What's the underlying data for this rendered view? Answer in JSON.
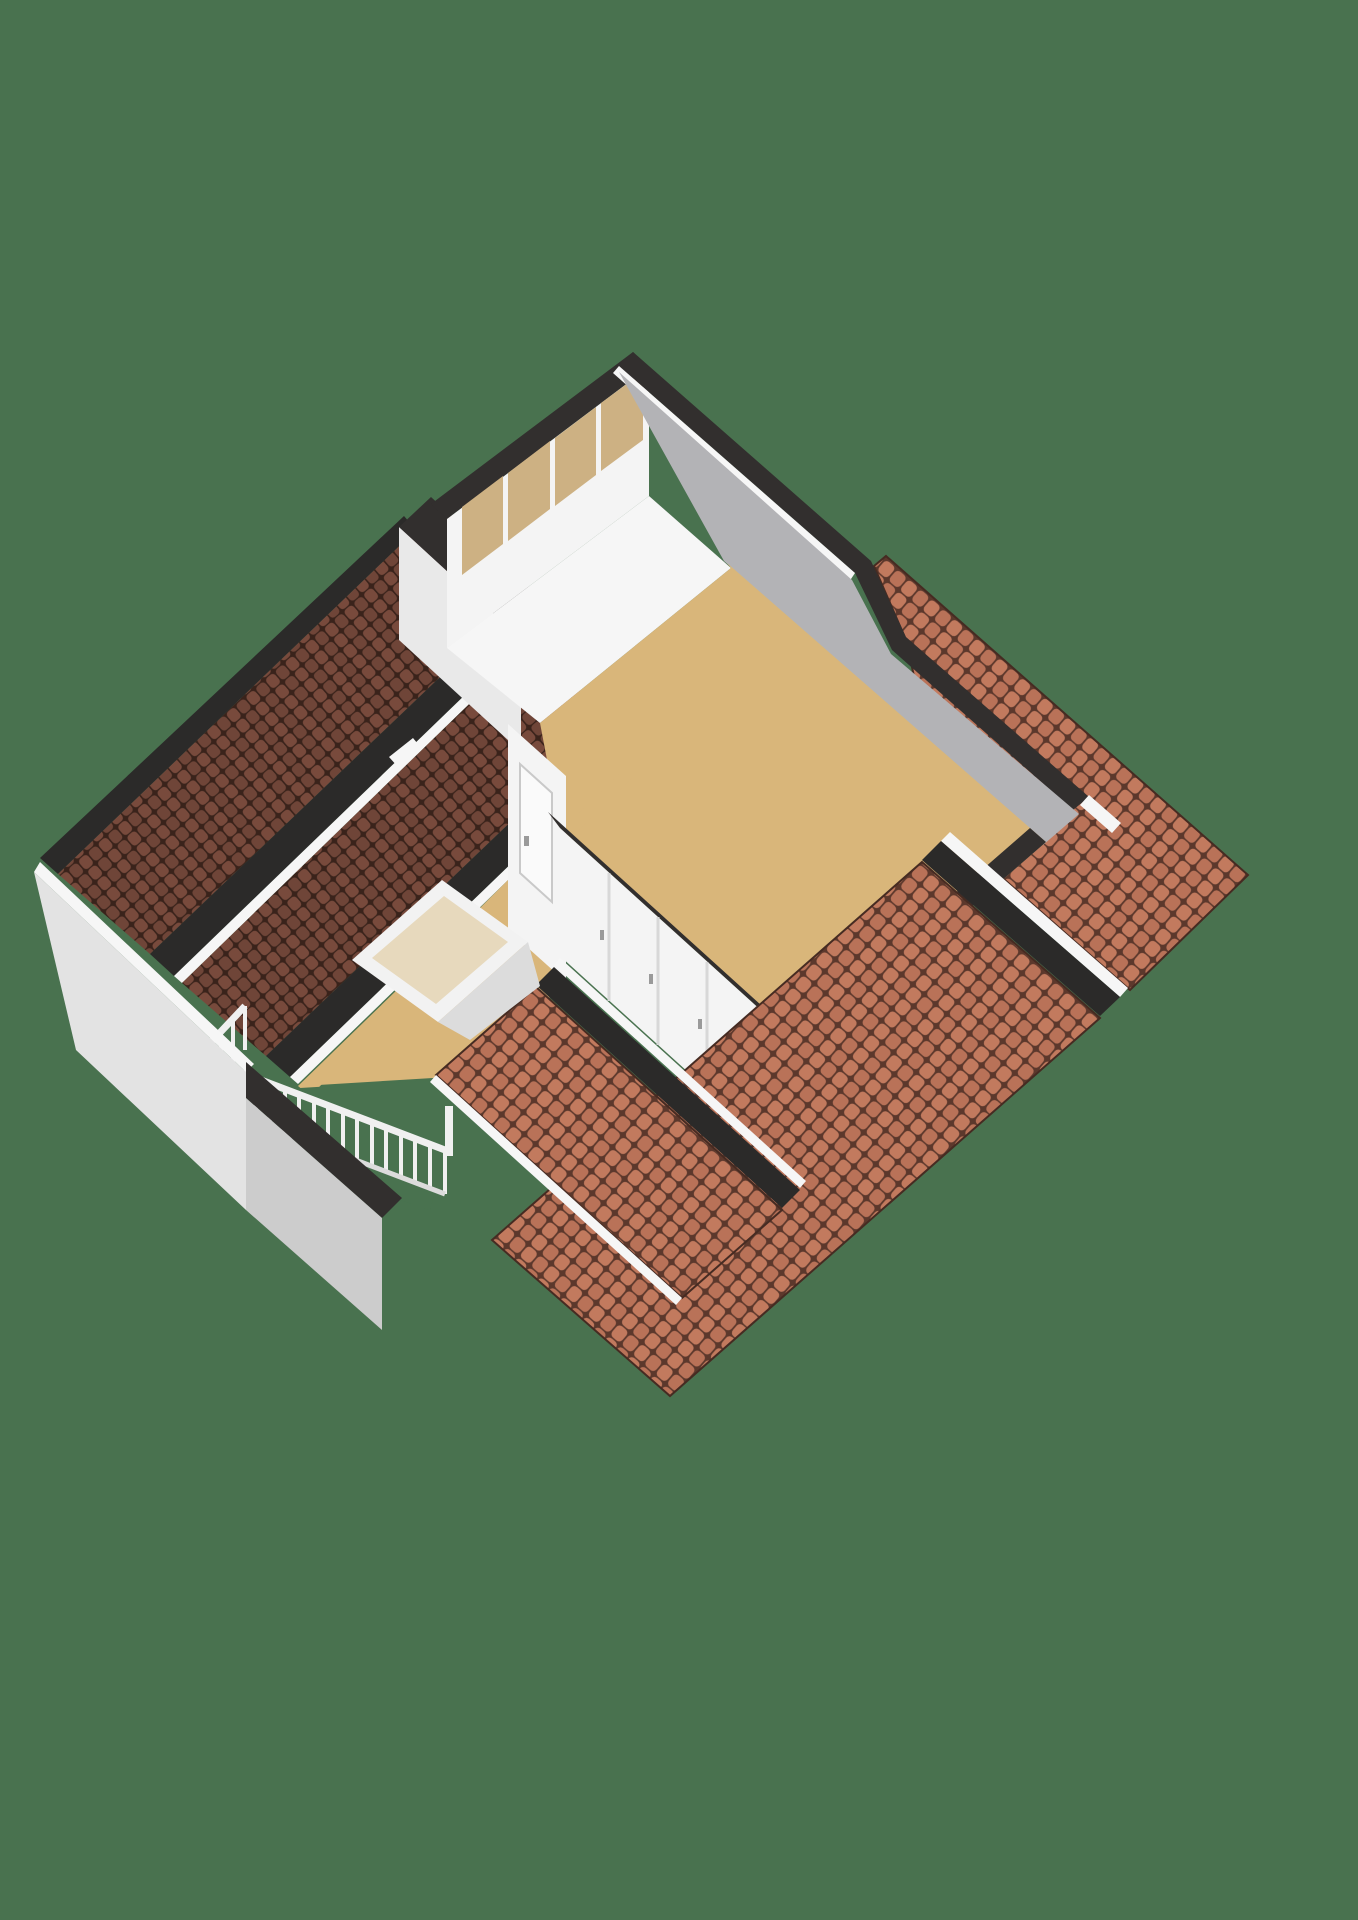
{
  "scene": {
    "kind": "isometric-3d-floorplan-render",
    "floor_shown": "attic-level",
    "element_counts": {
      "window_panes": 4,
      "closet_doors": 5,
      "railing_posts": 23,
      "roof_planes": 5,
      "skylight_hatches": 1,
      "interior_doors": 2
    }
  },
  "colors": {
    "background": "#49724f",
    "roofDark": "#6f4538",
    "roofDarkAlt": "#784a3c",
    "roofDarkLine": "#3a231b",
    "roofOrange": "#b97258",
    "roofOrangeAlt": "#c27a5e",
    "roofOrangeLine": "#5c382c",
    "beamBlack": "#2b2a29",
    "bandBlack": "#322f2e",
    "floorTan": "#d9b67a",
    "glassTan": "#cdb183",
    "wallWhite": "#f4f4f4",
    "wallLight": "#e9e9e9",
    "wallGray": "#b3b3b6",
    "gableLight": "#e3e3e3",
    "gableGray": "#cccccc",
    "trimWhite": "#f6f6f6",
    "railWhite": "#f0f0f0",
    "railShade": "#dcdcdc",
    "skylightFrame": "#f2f2f2",
    "skylightInner": "#e7d9bd",
    "doorWhite": "#fafafa",
    "doorLine": "#cfcfcf",
    "handleGray": "#9a9a9a"
  }
}
